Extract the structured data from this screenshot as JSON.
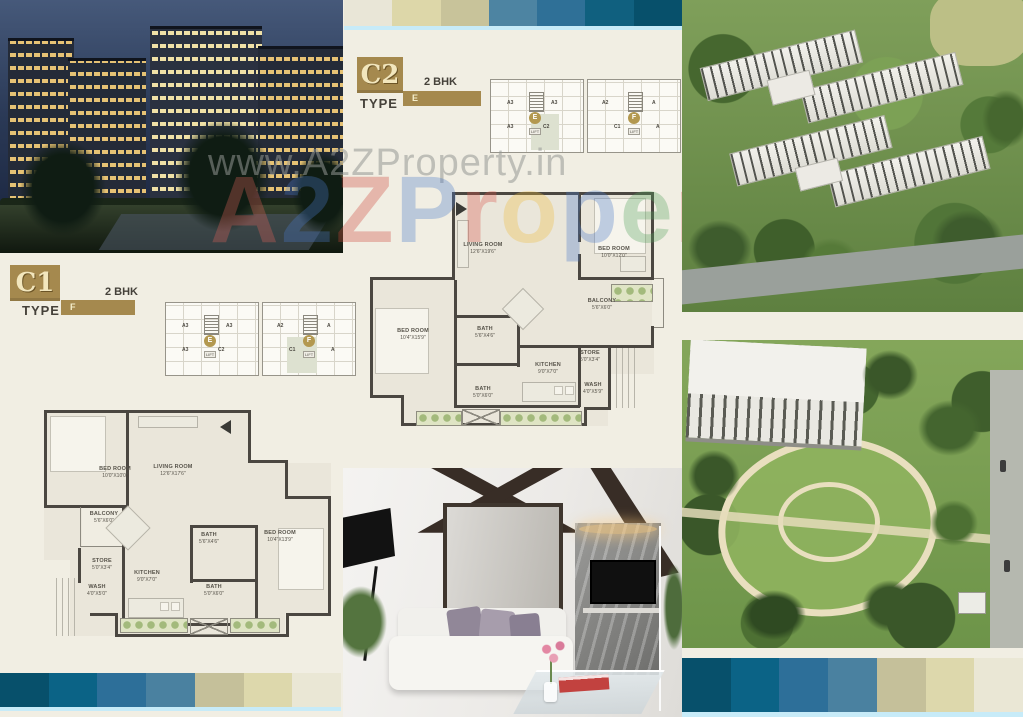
{
  "watermark": {
    "line1": "www.A2ZProperty.in",
    "brand_letters": [
      {
        "ch": "A",
        "color": "#e0635a"
      },
      {
        "ch": "2",
        "color": "#4a79c9"
      },
      {
        "ch": "Z",
        "color": "#cc4437"
      },
      {
        "ch": "P",
        "color": "#4a79c9"
      },
      {
        "ch": "r",
        "color": "#d9554a"
      },
      {
        "ch": "o",
        "color": "#eebd3e"
      },
      {
        "ch": "p",
        "color": "#4a79c9"
      },
      {
        "ch": "e",
        "color": "#55a35d"
      },
      {
        "ch": "r",
        "color": "#d9554a"
      },
      {
        "ch": "t",
        "color": "#eebd3e"
      },
      {
        "ch": "y",
        "color": "#4a79c9"
      }
    ]
  },
  "labels": {
    "type": "TYPE",
    "lift": "LIFT"
  },
  "units": {
    "c2": {
      "code": "C2",
      "type_letter": "E",
      "bhk": "2 BHK",
      "keyplan": {
        "wings": [
          {
            "units": [
              "A3",
              "A3",
              "A3",
              "C2"
            ],
            "circle": "E"
          },
          {
            "units": [
              "A2",
              "A",
              "C1",
              "A"
            ],
            "circle": "F"
          }
        ],
        "highlighted_unit": "C2"
      }
    },
    "c1": {
      "code": "C1",
      "type_letter": "F",
      "bhk": "2 BHK",
      "keyplan": {
        "wings": [
          {
            "units": [
              "A3",
              "A3",
              "A3",
              "C2"
            ],
            "circle": "E"
          },
          {
            "units": [
              "A2",
              "A",
              "C1",
              "A"
            ],
            "circle": "F"
          }
        ],
        "highlighted_unit": "C1"
      }
    }
  },
  "plans": {
    "c2": {
      "rooms": [
        {
          "label": "LIVING ROOM",
          "dims": "12'6\"X19'6\""
        },
        {
          "label": "BED ROOM",
          "dims": "10'0\"X12'0\""
        },
        {
          "label": "BALCONY",
          "dims": "5'6\"X6'0\""
        },
        {
          "label": "BED ROOM",
          "dims": "10'4\"X15'9\""
        },
        {
          "label": "BATH",
          "dims": "5'6\"X4'6\""
        },
        {
          "label": "KITCHEN",
          "dims": "9'0\"X7'0\""
        },
        {
          "label": "STORE",
          "dims": "5'0\"X3'4\""
        },
        {
          "label": "WASH",
          "dims": "4'0\"X5'9\""
        },
        {
          "label": "BATH",
          "dims": "5'0\"X6'0\""
        }
      ]
    },
    "c1": {
      "rooms": [
        {
          "label": "BED ROOM",
          "dims": "10'0\"X10'0\""
        },
        {
          "label": "LIVING ROOM",
          "dims": "12'6\"X17'6\""
        },
        {
          "label": "BALCONY",
          "dims": "5'6\"X6'0\""
        },
        {
          "label": "BATH",
          "dims": "5'6\"X4'6\""
        },
        {
          "label": "BED ROOM",
          "dims": "10'4\"X13'9\""
        },
        {
          "label": "STORE",
          "dims": "5'0\"X3'4\""
        },
        {
          "label": "KITCHEN",
          "dims": "9'0\"X7'0\""
        },
        {
          "label": "WASH",
          "dims": "4'0\"X5'0\""
        },
        {
          "label": "BATH",
          "dims": "5'0\"X6'0\""
        }
      ]
    }
  },
  "strips": {
    "top": [
      "#e9e6d7",
      "#ddd7a9",
      "#c8c39a",
      "#4d84a2",
      "#2f7097",
      "#10607f",
      "#07506b"
    ],
    "bottom_left": [
      "#07506b",
      "#0b6386",
      "#2d6f99",
      "#4a81a0",
      "#c5c09a",
      "#ddd8ac",
      "#eae7d5"
    ],
    "bottom_right": [
      "#07506b",
      "#0b6386",
      "#2d6f99",
      "#4a81a0",
      "#c5c09a",
      "#ddd8ac",
      "#eae7d5"
    ],
    "underline_color": "#c7ebf8"
  },
  "theme": {
    "accent_brown": "#a5894e",
    "page_bg": "#f1eee3",
    "wall_color": "#4b4741"
  }
}
